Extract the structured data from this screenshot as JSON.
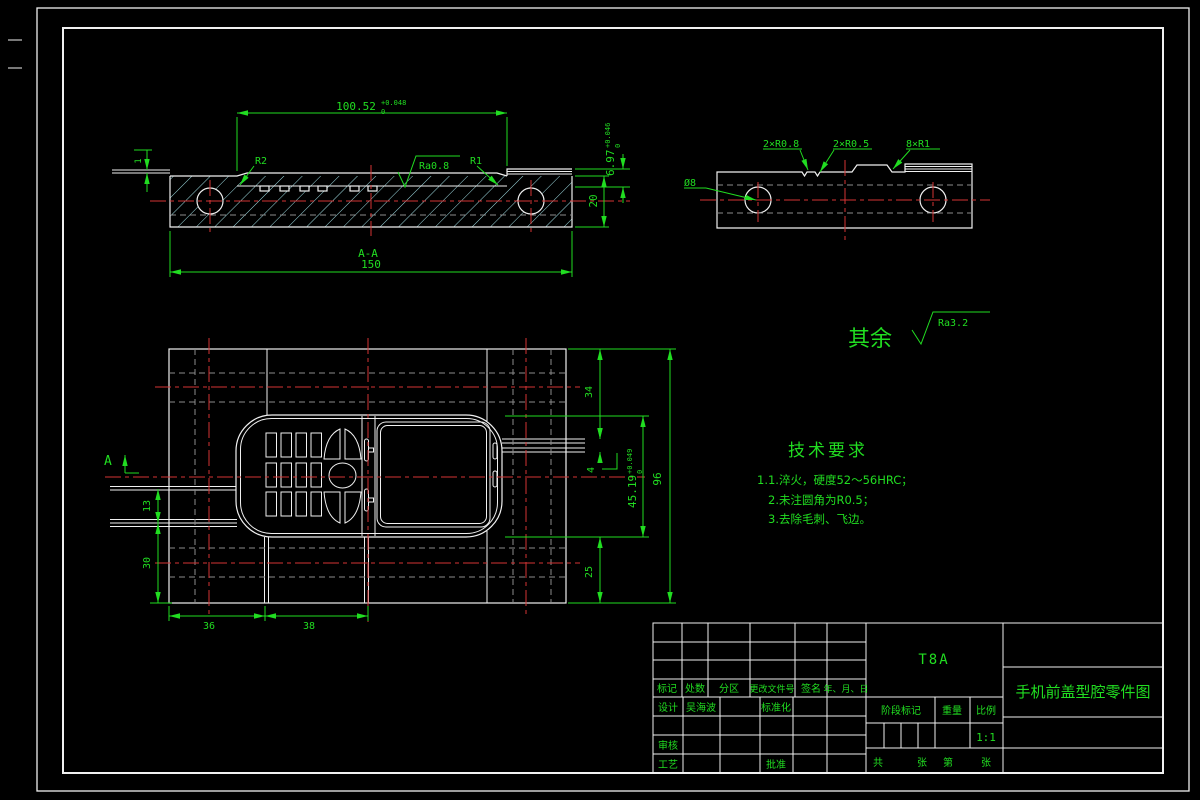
{
  "colors": {
    "background": "#000000",
    "outline_white": "#f0f0f0",
    "dimension_green": "#21dd21",
    "centerline_red": "#d43434",
    "hidden_gray": "#8b8b8b",
    "hatch_cyan": "#9fdce2"
  },
  "section_view": {
    "section_label": "A-A",
    "dim_total_width": "150",
    "dim_height": "20",
    "dim_step": "1",
    "dim_cavity_width": "100.52",
    "dim_cavity_width_tol_up": "+0.048",
    "dim_cavity_width_tol_low": "0",
    "dim_depth": "6.97",
    "dim_depth_tol_up": "+0.046",
    "dim_depth_tol_low": "0",
    "label_fillet_left": "R2",
    "label_fillet_right": "R1",
    "label_finish": "Ra0.8"
  },
  "side_view": {
    "label_hole": "Ø8",
    "label_notch1": "2×R0.8",
    "label_notch2": "2×R0.5",
    "label_rib": "8×R1"
  },
  "surface_note": {
    "prefix": "其余",
    "value": "Ra3.2"
  },
  "plan_view": {
    "section_arrow_label": "A",
    "dim_left_upper": "13",
    "dim_left_lower": "30",
    "dim_bottom_left": "36",
    "dim_bottom_right": "38",
    "dim_top_right": "34",
    "dim_gap": "4",
    "dim_cavity_height": "45.19",
    "dim_cavity_height_tol_up": "+0.049",
    "dim_cavity_height_tol_low": "0",
    "dim_bottom_margin": "25",
    "dim_total_height": "96"
  },
  "tech": {
    "heading": "技术要求",
    "item1": "1.1.淬火，硬度52～56HRC；",
    "item2": "2.未注圆角为R0.5；",
    "item3": "3.去除毛刺、飞边。"
  },
  "title_block": {
    "col_mark": "标记",
    "col_count": "处数",
    "col_zone": "分区",
    "col_doc": "更改文件号",
    "col_sign": "签名",
    "col_date": "年、月、日",
    "design_label": "设计",
    "designer": "吴海波",
    "standard_label": "标准化",
    "review_label": "审核",
    "process_label": "工艺",
    "approve_label": "批准",
    "stage_label": "阶段标记",
    "weight_label": "重量",
    "scale_label": "比例",
    "scale_value": "1:1",
    "sheet_total_label": "共",
    "sheet_unit1": "张",
    "sheet_no_label": "第",
    "sheet_unit2": "张",
    "material": "T8A",
    "drawing_title": "手机前盖型腔零件图"
  }
}
